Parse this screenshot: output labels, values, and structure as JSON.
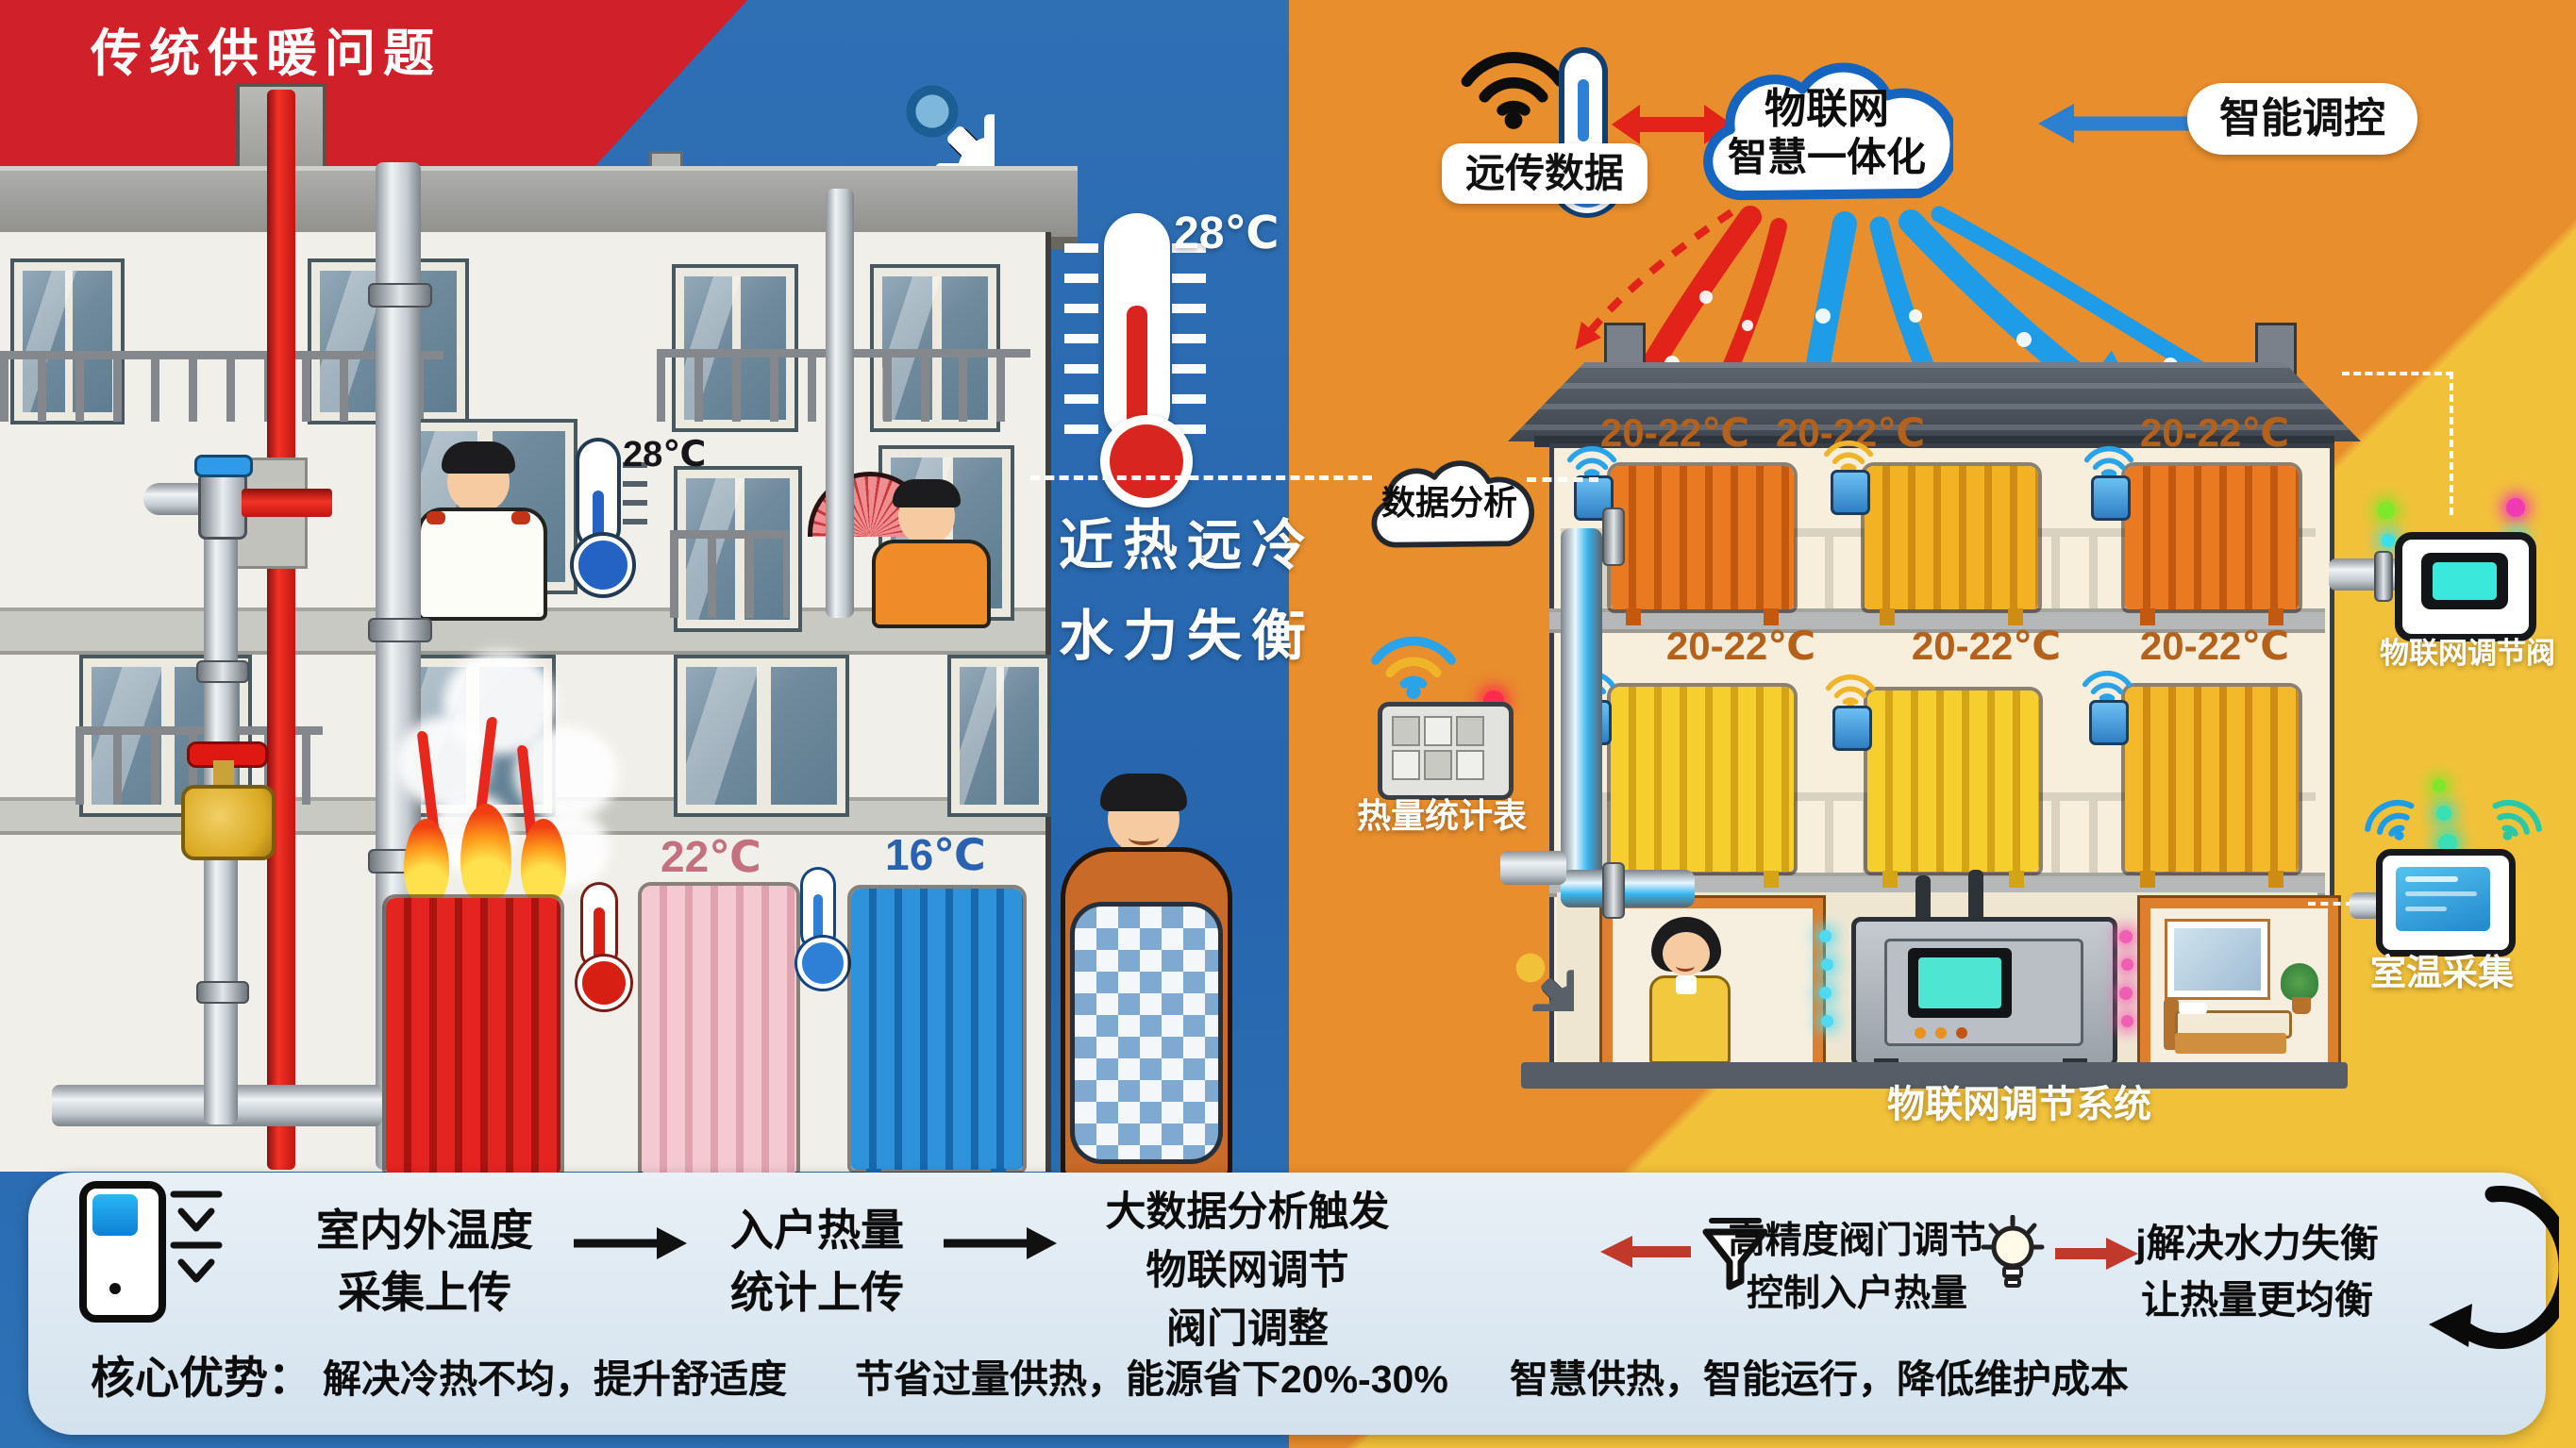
{
  "colors": {
    "left_bg": "#2766ae",
    "right_bg": "#e88e2d",
    "corner_red": "#d0202a",
    "bottom_right_yellow": "#f2c13a",
    "hot_arrow": "#e2231a",
    "cold_arrow": "#1f9ce8",
    "flow_bar_bg": "#dfe9f2"
  },
  "header": {
    "title": "传统供暖问题"
  },
  "left": {
    "slogan_line1": "近热远冷",
    "slogan_line2": "水力失衡",
    "outdoor_temp": "28℃",
    "indoor_temp": "28℃",
    "warm_temp": "22℃",
    "cold_temp": "16℃"
  },
  "right": {
    "remote_label": "远传数据",
    "cloud_line1": "物联网",
    "cloud_line2": "智慧一体化",
    "control_label": "智能调控",
    "analysis_label": "数据分析",
    "meter_label": "热量统计表",
    "valve_label": "物联网调节阀",
    "tablet_label": "室温采集",
    "system_label": "物联网调节系统",
    "room_temps": [
      "20-22℃",
      "20-22℃",
      "20-22℃",
      "20-22℃",
      "20-22℃",
      "20-22℃"
    ]
  },
  "flow": {
    "steps": [
      {
        "lines": [
          "室内外温度",
          "采集上传"
        ]
      },
      {
        "lines": [
          "入户热量",
          "统计上传"
        ]
      },
      {
        "lines": [
          "大数据分析触发",
          "物联网调节",
          "阀门调整"
        ]
      },
      {
        "lines": [
          "高精度阀门调节",
          "控制入户热量"
        ]
      },
      {
        "lines": [
          "j解决水力失衡",
          "让热量更均衡"
        ]
      }
    ],
    "benefits_title": "核心优势：",
    "benefits": [
      "解决冷热不均，提升舒适度",
      "节省过量供热，能源省下20%-30%",
      "智慧供热，智能运行，降低维护成本"
    ]
  }
}
